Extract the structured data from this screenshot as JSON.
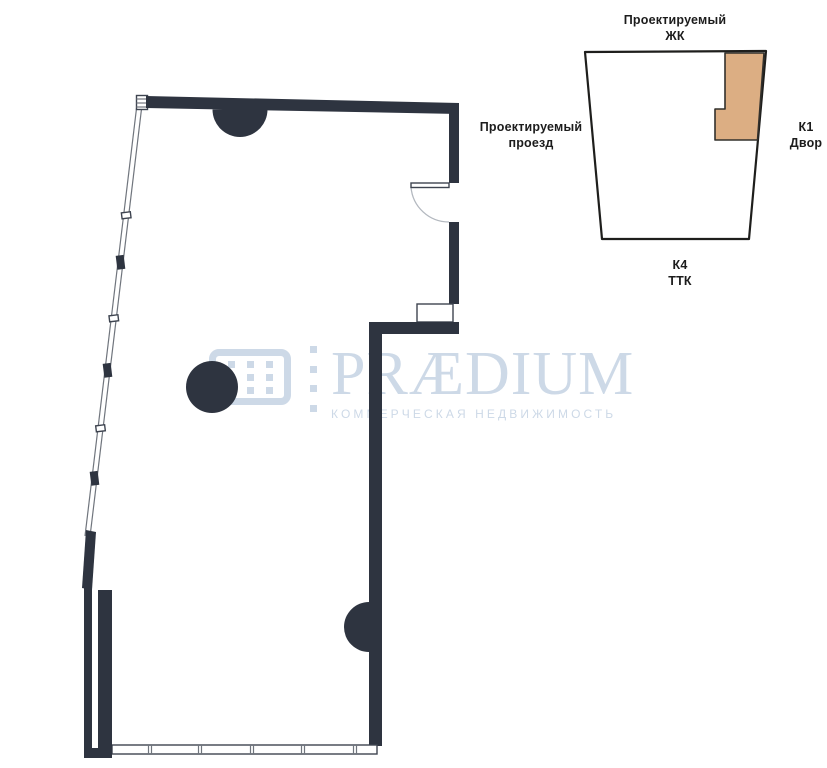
{
  "colors": {
    "wall": "#2e3440",
    "wall_outline": "#3e4450",
    "thin_line": "#70757d",
    "door_line": "#b3b8bf",
    "watermark": "#cdd9e7",
    "site_outline": "#1e1e1c",
    "unit_fill": "#dcae83",
    "unit_outline": "#32302c",
    "label_text": "#1c1c1c"
  },
  "watermark": {
    "brand": "PRÆDIUM",
    "tagline": "КОММЕРЧЕСКАЯ НЕДВИЖИМОСТЬ"
  },
  "site_map": {
    "top": {
      "line1": "Проектируемый",
      "line2": "ЖК"
    },
    "left": {
      "line1": "Проектируемый",
      "line2": "проезд"
    },
    "right": {
      "line1": "К1",
      "line2": "Двор"
    },
    "bottom": {
      "line1": "К4",
      "line2": "ТТК"
    }
  }
}
